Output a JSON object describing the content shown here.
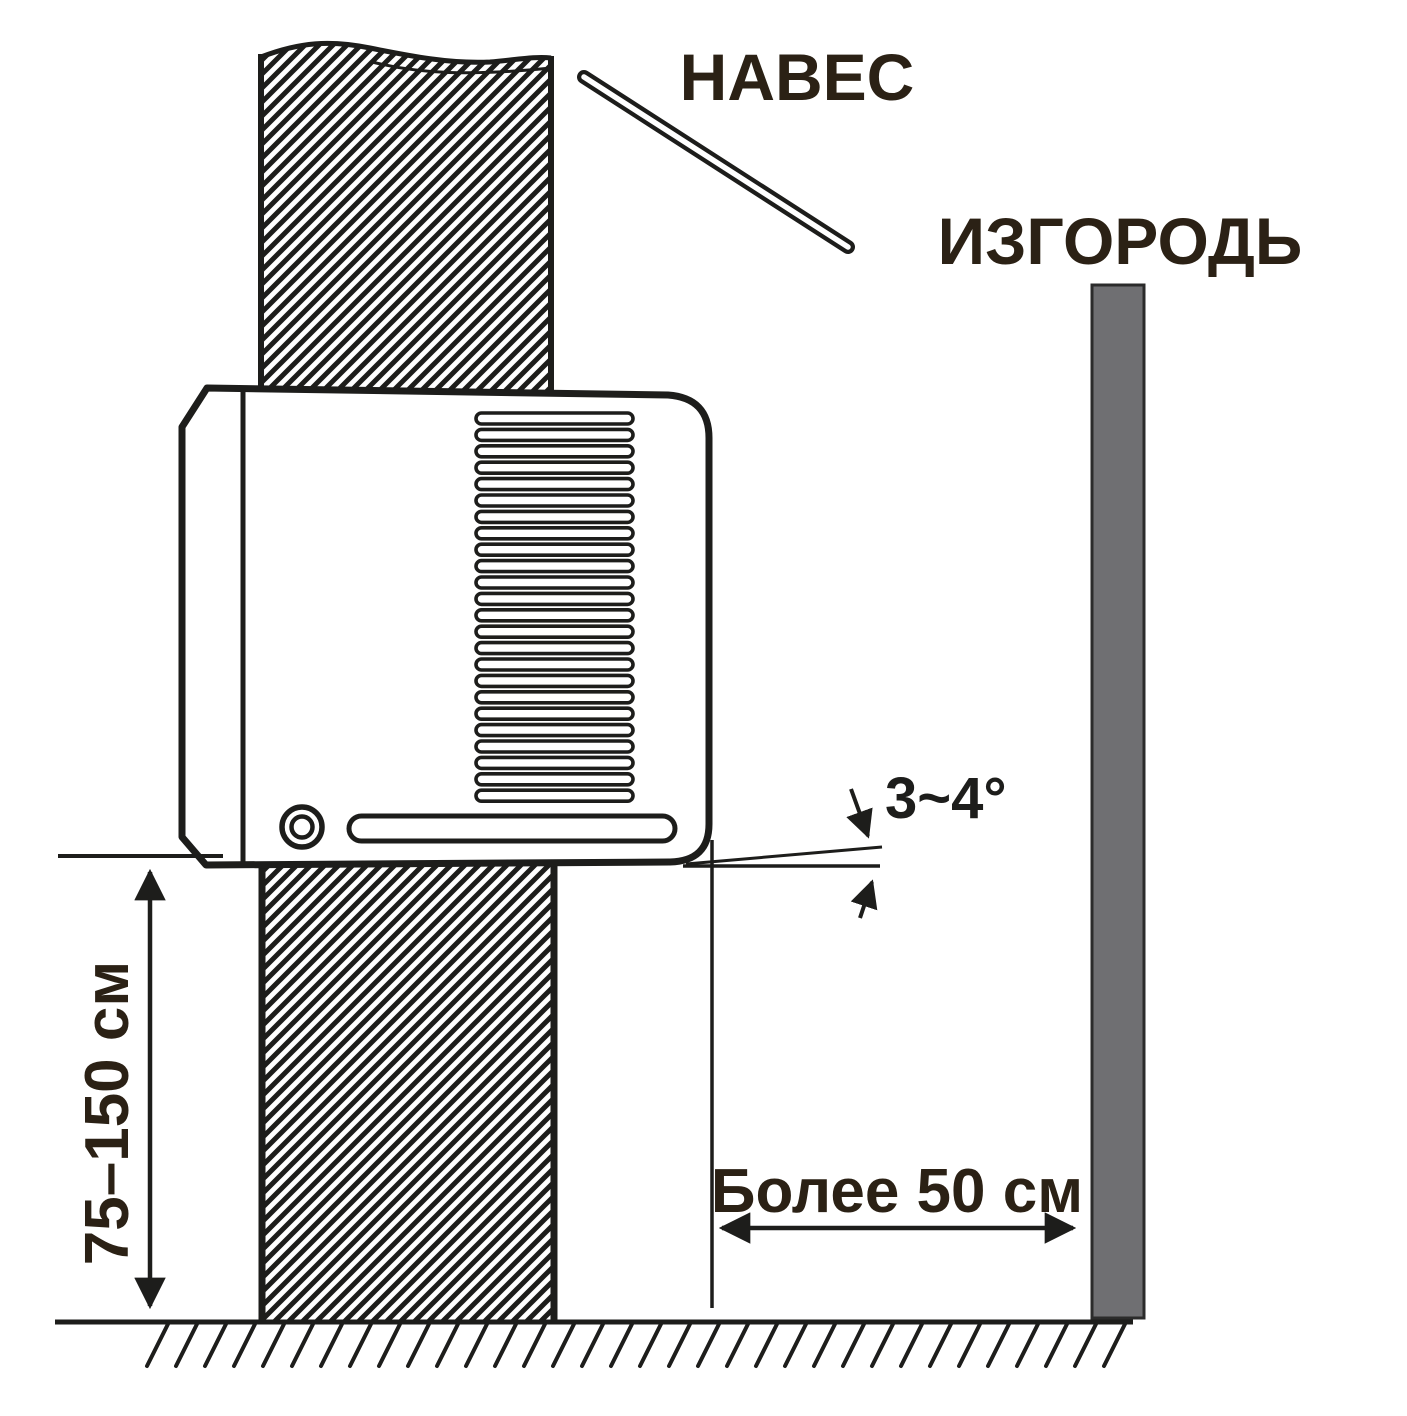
{
  "labels": {
    "canopy": "НАВЕС",
    "fence": "ИЗГОРОДЬ",
    "angle": "3~4°",
    "height_range": "75–150 см",
    "distance": "Более 50 см"
  },
  "colors": {
    "ink": "#1d1d1b",
    "label_text": "#2b2115",
    "fence_fill": "#6f6f72",
    "fence_stroke": "#2b2b2b",
    "background": "#ffffff"
  }
}
